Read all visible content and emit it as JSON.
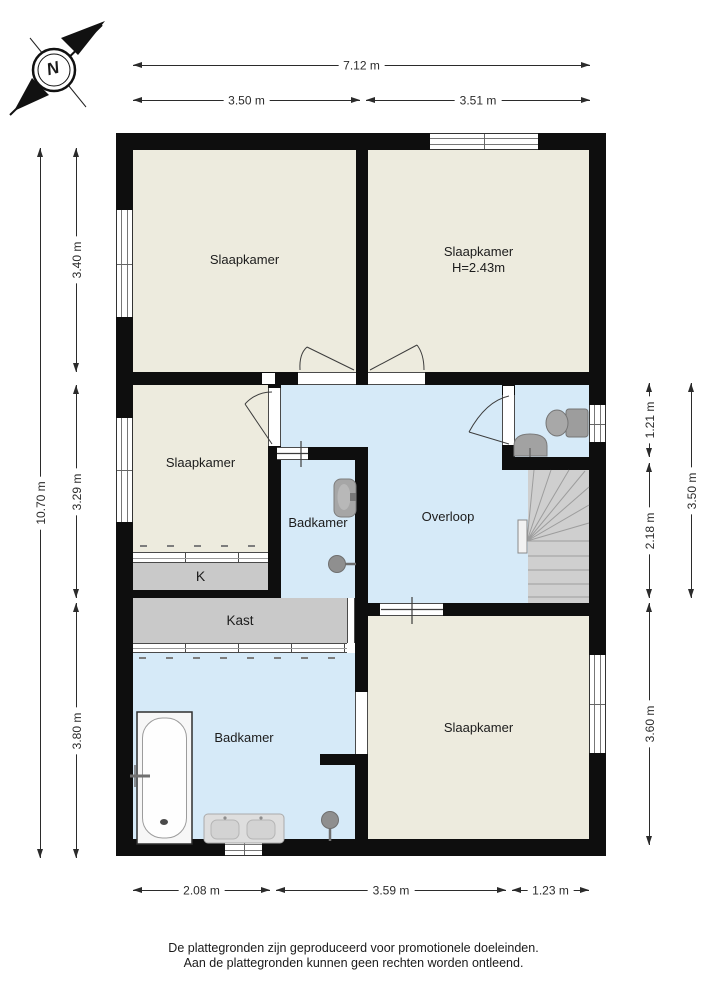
{
  "compass": {
    "north_label": "N"
  },
  "rooms": {
    "slaapkamer_top_left": "Slaapkamer",
    "slaapkamer_top_right": "Slaapkamer",
    "slaapkamer_top_right_height": "H=2.43m",
    "slaapkamer_mid_left": "Slaapkamer",
    "badkamer_mid": "Badkamer",
    "overloop": "Overloop",
    "closet_k": "K",
    "kast": "Kast",
    "badkamer_bottom": "Badkamer",
    "slaapkamer_bottom_right": "Slaapkamer"
  },
  "dims": {
    "top_total": "7.12 m",
    "top_left": "3.50 m",
    "top_right": "3.51 m",
    "left_total": "10.70 m",
    "left_top": "3.40 m",
    "left_mid": "3.29 m",
    "left_bottom": "3.80 m",
    "right_wc": "1.21 m",
    "right_stairs": "2.18 m",
    "right_bottom": "3.60 m",
    "right_total": "3.50 m",
    "bottom_left": "2.08 m",
    "bottom_mid": "3.59 m",
    "bottom_right": "1.23 m"
  },
  "footer": {
    "line1": "De plattegronden zijn geproduceerd voor promotionele doeleinden.",
    "line2": "Aan de plattegronden kunnen geen rechten worden ontleend."
  },
  "colors": {
    "room_fill": "#EDEBDE",
    "wet_fill": "#D6EAF8",
    "closet_fill": "#C9C9C9",
    "wall": "#0E0E0E"
  }
}
